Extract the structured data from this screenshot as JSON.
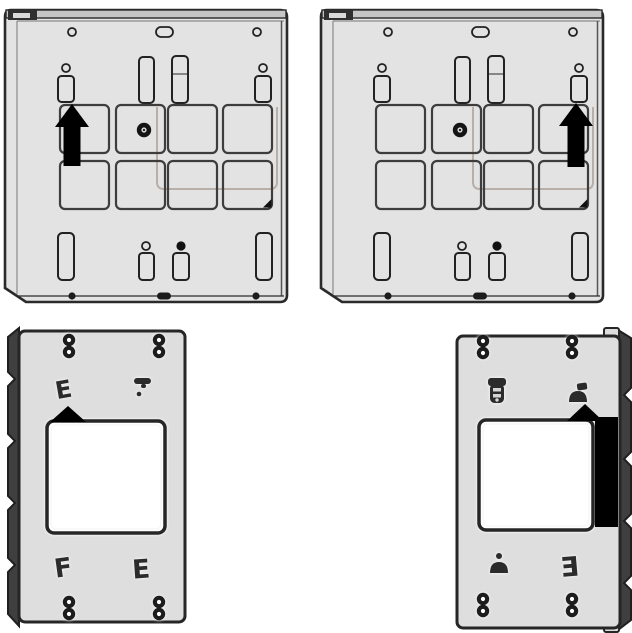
{
  "canvas": {
    "width": 632,
    "height": 633,
    "background": "#ffffff"
  },
  "diagram": {
    "type": "installation-diagram",
    "description": "Four mounting plates; black arrows indicate upward mounting direction",
    "colors": {
      "plate_fill": "#e3e3e3",
      "bracket_fill": "#dedede",
      "outline": "#2a2a2a",
      "arrow": "#000000",
      "faint_guide": "#b8afa9"
    },
    "panels": {
      "top_left_plate": {
        "name": "rear mounting plate",
        "arrow_direction": "up",
        "arrow_position": "left-column"
      },
      "top_right_plate": {
        "name": "rear mounting plate",
        "arrow_direction": "up",
        "arrow_position": "right-column"
      },
      "bottom_left_bracket": {
        "name": "mounting bracket with cutout",
        "arrow_direction": "up",
        "arrow_position": "top-left-of-cutout",
        "glyph_upper_left": "E",
        "glyph_lower_left": "F",
        "glyph_lower_right": "E"
      },
      "bottom_right_bracket": {
        "name": "mounting bracket with cutout",
        "arrow_direction": "up",
        "arrow_position": "top-right-of-cutout",
        "glyph_lower_right": "Ǝ"
      }
    }
  }
}
